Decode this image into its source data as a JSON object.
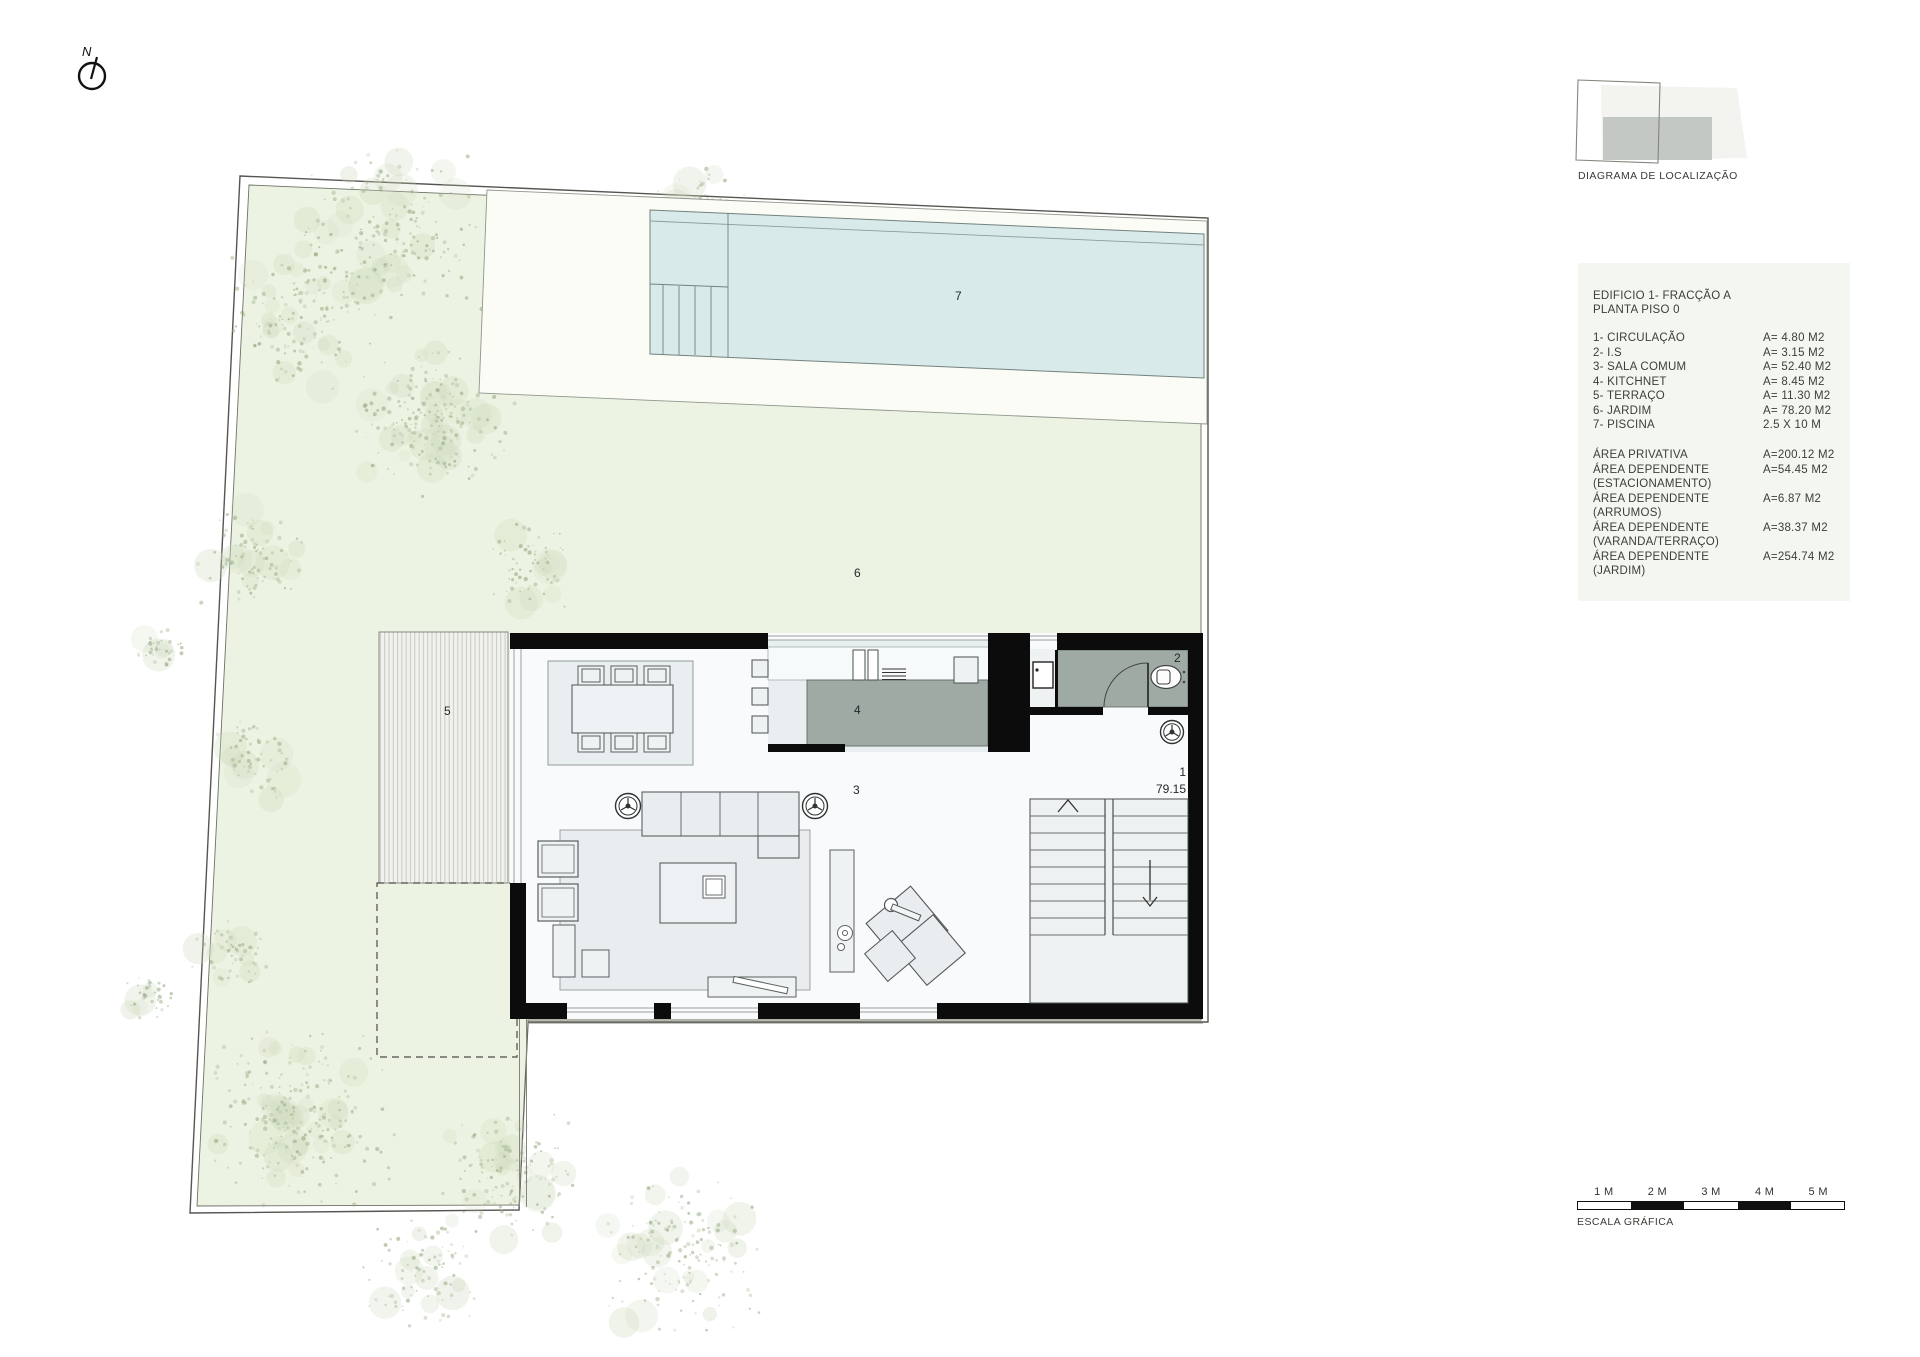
{
  "north": {
    "label": "N"
  },
  "location_diagram": {
    "caption": "DIAGRAMA DE LOCALIZAÇÃO"
  },
  "legend": {
    "title_line1": "EDIFICIO 1- FRACÇÃO A",
    "title_line2": "PLANTA PISO 0",
    "items": [
      {
        "label": "1- CIRCULAÇÃO",
        "value": "A= 4.80 M2"
      },
      {
        "label": "2- I.S",
        "value": "A= 3.15 M2"
      },
      {
        "label": "3- SALA COMUM",
        "value": "A= 52.40 M2"
      },
      {
        "label": "4- KITCHNET",
        "value": "A= 8.45 M2"
      },
      {
        "label": "5- TERRAÇO",
        "value": "A= 11.30 M2"
      },
      {
        "label": "6- JARDIM",
        "value": "A= 78.20 M2"
      },
      {
        "label": "7- PISCINA",
        "value": "2.5 X 10 M"
      }
    ],
    "areas": [
      {
        "label": "ÁREA PRIVATIVA",
        "label2": "",
        "value": "A=200.12 M2"
      },
      {
        "label": "ÁREA DEPENDENTE",
        "label2": "(ESTACIONAMENTO)",
        "value": "A=54.45 M2"
      },
      {
        "label": "ÁREA DEPENDENTE",
        "label2": "(ARRUMOS)",
        "value": "A=6.87 M2"
      },
      {
        "label": "ÁREA DEPENDENTE",
        "label2": "(VARANDA/TERRAÇO)",
        "value": "A=38.37 M2"
      },
      {
        "label": "ÁREA DEPENDENTE",
        "label2": "(JARDIM)",
        "value": "A=254.74 M2"
      }
    ]
  },
  "plan": {
    "room_labels": {
      "circulation": "1",
      "level": "79.15",
      "bathroom": "2",
      "living": "3",
      "kitchen": "4",
      "terrace": "5",
      "garden": "6",
      "pool": "7"
    }
  },
  "scale_bar": {
    "caption": "ESCALA GRÁFICA",
    "ticks": [
      "1 M",
      "2 M",
      "3 M",
      "4 M",
      "5 M"
    ]
  },
  "colors": {
    "garden_green": "#edf3e2",
    "pool_cyan": "#d8eae9",
    "deck_white": "#fbfcf6",
    "counter_gray": "#9faaa4",
    "wall_black": "#0c0c0c",
    "legend_bg": "#f4f6f1"
  }
}
